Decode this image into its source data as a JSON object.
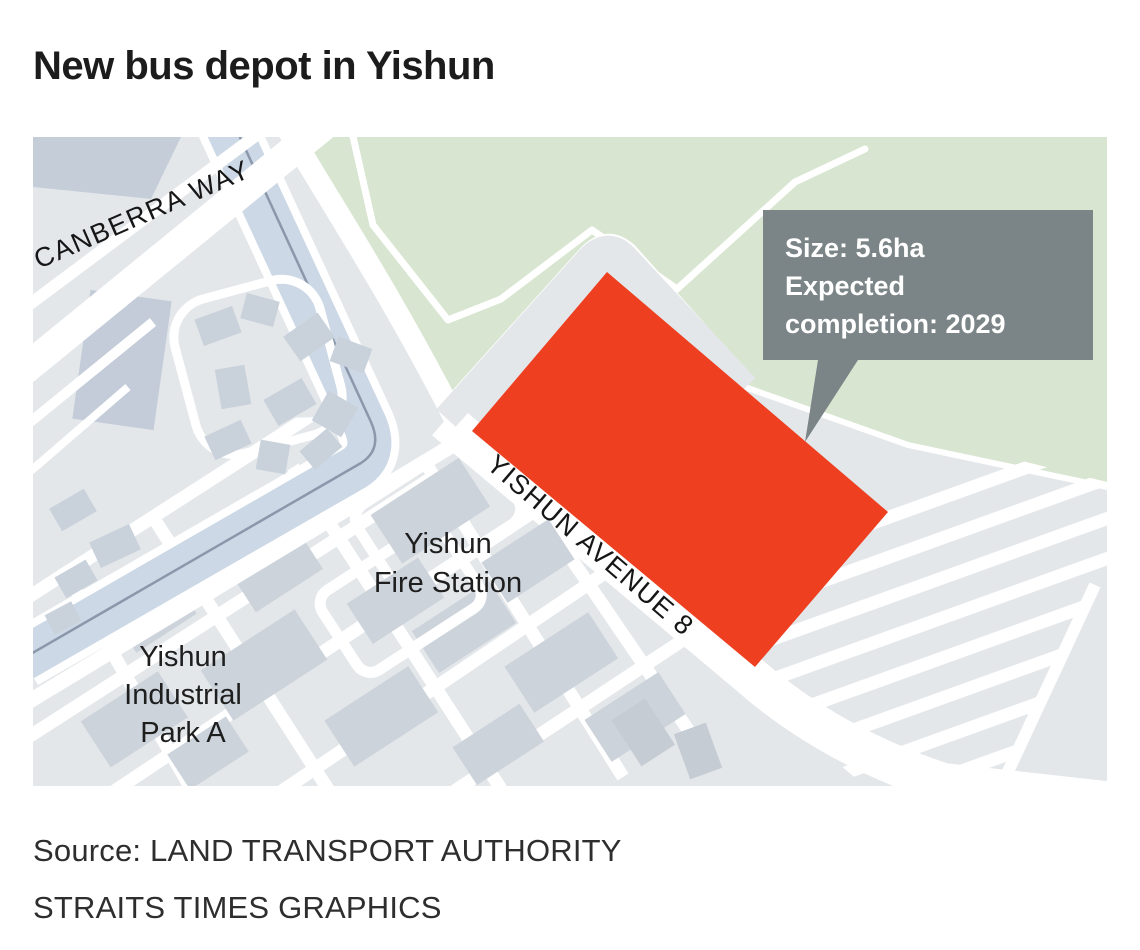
{
  "title": "New bus depot in Yishun",
  "map": {
    "road_labels": {
      "canberra_way": "CANBERRA WAY",
      "yishun_avenue_8": "YISHUN AVENUE 8"
    },
    "place_labels": {
      "fire_station_line1": "Yishun",
      "fire_station_line2": "Fire Station",
      "industrial_line1": "Yishun",
      "industrial_line2": "Industrial",
      "industrial_line3": "Park A"
    },
    "callout": {
      "line1": "Size: 5.6ha",
      "line2": "Expected",
      "line3": "completion: 2029"
    },
    "colors": {
      "site": "#ee3f20",
      "callout_bg": "#7b8486",
      "park_green": "#d8e5d0",
      "water": "#ccd8e5",
      "land": "#e4e7ea",
      "building": "#ccd3db"
    }
  },
  "source": {
    "line1": "Source: LAND TRANSPORT AUTHORITY",
    "line2": "STRAITS TIMES GRAPHICS"
  }
}
